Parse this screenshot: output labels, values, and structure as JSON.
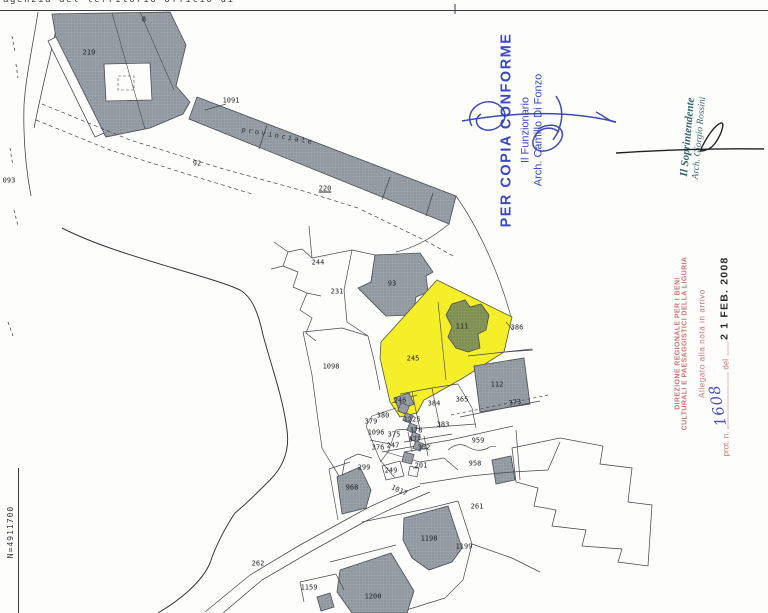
{
  "page": {
    "header": "agenzia del territorio    Ufficio di",
    "coordinate_label": "N=4911700"
  },
  "map": {
    "road_label": "provinciale",
    "highlight_color": "#f5ef2a",
    "building_color": "#99a0a8",
    "green_building_color": "#87975a",
    "labels": [
      {
        "t": "093",
        "x": 9,
        "y": 181
      },
      {
        "t": "8",
        "x": 144,
        "y": 20
      },
      {
        "t": "219",
        "x": 89,
        "y": 53
      },
      {
        "t": "1091",
        "x": 231,
        "y": 101
      },
      {
        "t": "92",
        "x": 197,
        "y": 164
      },
      {
        "t": "220",
        "x": 325,
        "y": 189,
        "u": true
      },
      {
        "t": "244",
        "x": 318,
        "y": 263
      },
      {
        "t": "231",
        "x": 337,
        "y": 292
      },
      {
        "t": "93",
        "x": 392,
        "y": 284
      },
      {
        "t": "386",
        "x": 517,
        "y": 328
      },
      {
        "t": "111",
        "x": 462,
        "y": 327
      },
      {
        "t": "245",
        "x": 413,
        "y": 359
      },
      {
        "t": "1098",
        "x": 331,
        "y": 367
      },
      {
        "t": "246",
        "x": 400,
        "y": 401
      },
      {
        "t": "384",
        "x": 434,
        "y": 404
      },
      {
        "t": "365",
        "x": 462,
        "y": 400
      },
      {
        "t": "112",
        "x": 497,
        "y": 385
      },
      {
        "t": "373",
        "x": 515,
        "y": 403,
        "r": -8
      },
      {
        "t": "380",
        "x": 383,
        "y": 416
      },
      {
        "t": "379",
        "x": 371,
        "y": 422
      },
      {
        "t": "1225",
        "x": 412,
        "y": 420
      },
      {
        "t": "383",
        "x": 443,
        "y": 425
      },
      {
        "t": "1096",
        "x": 376,
        "y": 433
      },
      {
        "t": "375",
        "x": 394,
        "y": 435
      },
      {
        "t": "378",
        "x": 416,
        "y": 431
      },
      {
        "t": "377",
        "x": 415,
        "y": 440
      },
      {
        "t": "382",
        "x": 424,
        "y": 448
      },
      {
        "t": "247",
        "x": 393,
        "y": 446
      },
      {
        "t": "376",
        "x": 378,
        "y": 448
      },
      {
        "t": "299",
        "x": 364,
        "y": 468
      },
      {
        "t": "249",
        "x": 391,
        "y": 471
      },
      {
        "t": "201",
        "x": 421,
        "y": 466
      },
      {
        "t": "959",
        "x": 478,
        "y": 441
      },
      {
        "t": "958",
        "x": 475,
        "y": 464
      },
      {
        "t": "968",
        "x": 352,
        "y": 488
      },
      {
        "t": "1017",
        "x": 399,
        "y": 491,
        "r": 25
      },
      {
        "t": "261",
        "x": 477,
        "y": 507
      },
      {
        "t": "1198",
        "x": 429,
        "y": 539
      },
      {
        "t": "1199",
        "x": 464,
        "y": 547
      },
      {
        "t": "262",
        "x": 258,
        "y": 564
      },
      {
        "t": "1159",
        "x": 309,
        "y": 588
      },
      {
        "t": "1200",
        "x": 373,
        "y": 597
      }
    ]
  },
  "stamps": {
    "copia_conforme": {
      "title": "PER COPIA CONFORME",
      "role": "Il Funzionario",
      "name": "Arch. Camillo Di Fonzo",
      "color": "#2b3bbf"
    },
    "soprintendente": {
      "role": "Il Soprintendente",
      "name": "Arch. Giorgio Rossini",
      "color": "#35656b"
    },
    "direzione": {
      "line1": "DIREZIONE REGIONALE PER I BENI",
      "line2": "CULTURALI E PAESAGGISTICI DELLA LIGURIA",
      "line3": "Allegato alla nota in arrivo",
      "prot_prefix": "prot. n.",
      "prot_mid": "del",
      "prot_number": "1608",
      "date": "2 1 FEB. 2008",
      "color": "#c96f6e"
    }
  }
}
